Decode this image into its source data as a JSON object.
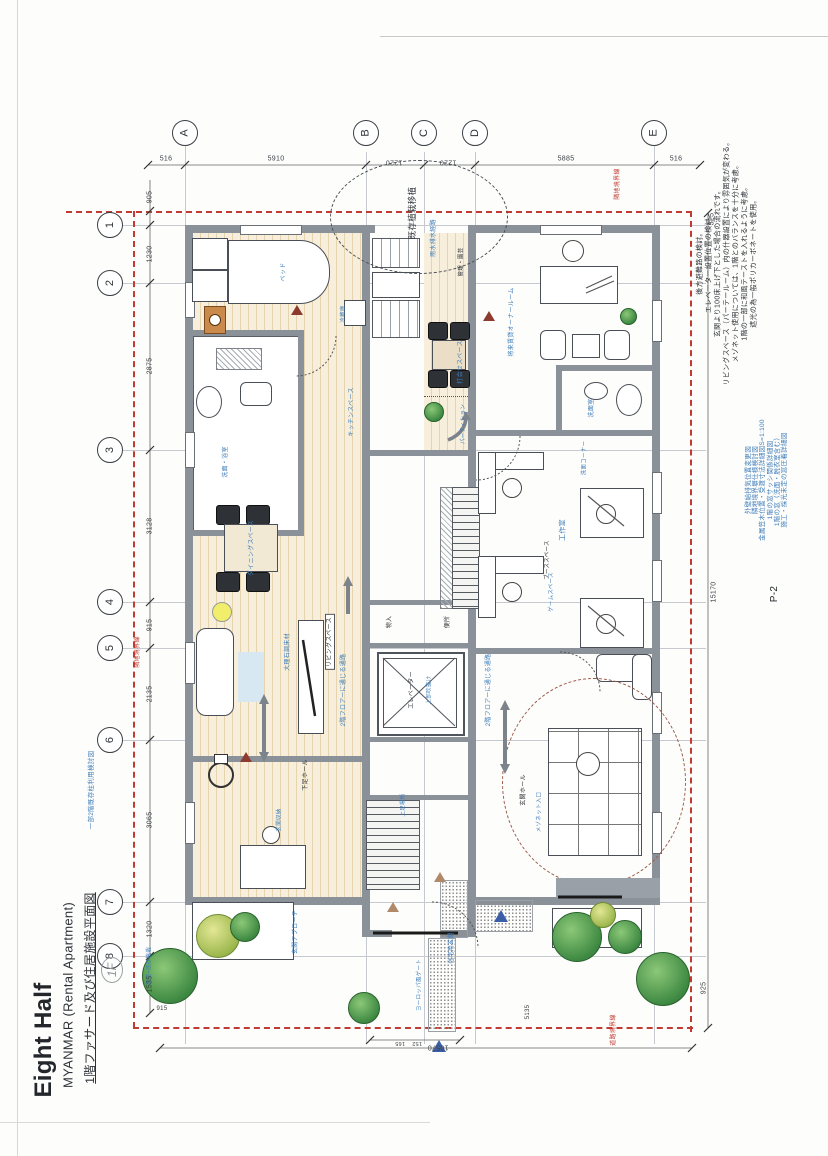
{
  "document": {
    "title": "Eight Half",
    "subtitle": "MYANMAR (Rental Apartment)",
    "drawing_title": "1階ファサード及び住居施設平面図",
    "handwritten_mark": "1F",
    "sheet_number": "P-2"
  },
  "grid": {
    "columns": [
      {
        "label": "A",
        "x": 185
      },
      {
        "label": "B",
        "x": 366
      },
      {
        "label": "C",
        "x": 424
      },
      {
        "label": "D",
        "x": 475
      },
      {
        "label": "E",
        "x": 654
      }
    ],
    "rows": [
      {
        "label": "1",
        "y": 225
      },
      {
        "label": "2",
        "y": 283
      },
      {
        "label": "3",
        "y": 450
      },
      {
        "label": "4",
        "y": 602
      },
      {
        "label": "5",
        "y": 648
      },
      {
        "label": "6",
        "y": 740
      },
      {
        "label": "7",
        "y": 902
      },
      {
        "label": "8",
        "y": 956
      }
    ]
  },
  "dimensions": [
    {
      "t": "516",
      "x": 166,
      "y": 159,
      "r": 0
    },
    {
      "t": "5910",
      "x": 276,
      "y": 159,
      "r": 0
    },
    {
      "t": "1220",
      "x": 394,
      "y": 162,
      "r": 180
    },
    {
      "t": "1220",
      "x": 448,
      "y": 162,
      "r": 180
    },
    {
      "t": "5885",
      "x": 566,
      "y": 159,
      "r": 0
    },
    {
      "t": "516",
      "x": 676,
      "y": 159,
      "r": 0
    },
    {
      "t": "905",
      "x": 150,
      "y": 197
    },
    {
      "t": "1230",
      "x": 150,
      "y": 254
    },
    {
      "t": "2875",
      "x": 150,
      "y": 366
    },
    {
      "t": "3128",
      "x": 150,
      "y": 526
    },
    {
      "t": "915",
      "x": 150,
      "y": 625
    },
    {
      "t": "2135",
      "x": 150,
      "y": 694
    },
    {
      "t": "3065",
      "x": 150,
      "y": 820
    },
    {
      "t": "1320",
      "x": 150,
      "y": 929
    },
    {
      "t": "1535",
      "x": 150,
      "y": 984
    },
    {
      "t": "325",
      "x": 712,
      "y": 219
    },
    {
      "t": "15170",
      "x": 714,
      "y": 592
    },
    {
      "t": "925",
      "x": 704,
      "y": 988
    },
    {
      "t": "10570",
      "x": 438,
      "y": 1047,
      "r": 180
    },
    {
      "t": "165",
      "x": 400,
      "y": 1042,
      "r": 180,
      "s": 5.5
    },
    {
      "t": "152",
      "x": 417,
      "y": 1042,
      "r": 180,
      "s": 5.5
    },
    {
      "t": "5135",
      "x": 528,
      "y": 1012,
      "s": 6
    },
    {
      "t": "915",
      "x": 162,
      "y": 1009,
      "r": 0,
      "s": 6
    }
  ],
  "notes_black": [
    "後方避難路の検討。",
    "エレベーター設置位置の検討。",
    "玄関より100床上げ下とした場合の流れです。",
    "リビングスペース（パーテールーム）内の什器設置により雰囲気が変わる。",
    "メゾネット使用については、1階とのバランスを十分に考慮。",
    "1階の一部に和風テーストを入れるように考慮。",
    "遮光の為一般ポリカーボネートを使用。"
  ],
  "notes_blue": [
    "外壁給排気位置変更図",
    "隣地境界塀仕様検討図",
    "金属笠木位置・受渡寸法詳細図S=1:100",
    "1階の窓サッシ関係詳細図",
    "1階の窓（洗面・脱衣室含む）",
    "施工・採光未定の窓圧着詳細図"
  ],
  "plan_labels": [
    {
      "t": "ベッド",
      "x": 284,
      "y": 272,
      "s": 6,
      "c": "blue"
    },
    {
      "t": "洗面・浴室",
      "x": 226,
      "y": 462,
      "s": 6,
      "c": "blue"
    },
    {
      "t": "ダイニングスペース",
      "x": 252,
      "y": 548,
      "s": 6,
      "c": "blue"
    },
    {
      "t": "リビングスペース",
      "x": 330,
      "y": 642,
      "s": 6,
      "c": "black",
      "box": true
    },
    {
      "t": "大理石調床材",
      "x": 288,
      "y": 652,
      "s": 6,
      "c": "blue"
    },
    {
      "t": "キッチンスペース",
      "x": 352,
      "y": 412,
      "s": 6,
      "c": "blue"
    },
    {
      "t": "冷蔵庫",
      "x": 344,
      "y": 314,
      "s": 5.5,
      "c": "blue"
    },
    {
      "t": "下足ホール",
      "x": 306,
      "y": 775,
      "s": 6,
      "c": "black"
    },
    {
      "t": "玄関収納",
      "x": 280,
      "y": 820,
      "s": 5.5,
      "c": "blue"
    },
    {
      "t": "住宅用玄関",
      "x": 452,
      "y": 948,
      "s": 6,
      "c": "blue"
    },
    {
      "t": "玄関アプローチ",
      "x": 296,
      "y": 932,
      "s": 6,
      "c": "blue"
    },
    {
      "t": "ヨーロッパ風ゲート",
      "x": 420,
      "y": 985,
      "s": 5.5,
      "c": "blue"
    },
    {
      "t": "既存植栽移植",
      "x": 412,
      "y": 213,
      "s": 8.5,
      "c": "black"
    },
    {
      "t": "雨水排水経路",
      "x": 434,
      "y": 238,
      "s": 6,
      "c": "blue"
    },
    {
      "t": "管理・園芸",
      "x": 462,
      "y": 262,
      "s": 5.5,
      "c": "black"
    },
    {
      "t": "エレベーター",
      "x": 412,
      "y": 690,
      "s": 6,
      "c": "black"
    },
    {
      "t": "上部吹抜け",
      "x": 430,
      "y": 690,
      "s": 5.5,
      "c": "blue"
    },
    {
      "t": "便所",
      "x": 448,
      "y": 622,
      "s": 6,
      "c": "black"
    },
    {
      "t": "物入",
      "x": 390,
      "y": 622,
      "s": 6,
      "c": "black"
    },
    {
      "t": "打合せスペース",
      "x": 461,
      "y": 362,
      "s": 6,
      "c": "blue"
    },
    {
      "t": "パーティション",
      "x": 464,
      "y": 424,
      "s": 5.5,
      "c": "blue"
    },
    {
      "t": "将来賃貸オーナールーム",
      "x": 512,
      "y": 322,
      "s": 6,
      "c": "blue"
    },
    {
      "t": "洗面室",
      "x": 592,
      "y": 408,
      "s": 6,
      "c": "blue"
    },
    {
      "t": "洗面コーナー",
      "x": 585,
      "y": 458,
      "s": 5.5,
      "c": "blue"
    },
    {
      "t": "工作室",
      "x": 563,
      "y": 530,
      "s": 7,
      "c": "blue"
    },
    {
      "t": "ブーススペース",
      "x": 548,
      "y": 560,
      "s": 5.5,
      "c": "black"
    },
    {
      "t": "ゲームスペース",
      "x": 552,
      "y": 592,
      "s": 5.5,
      "c": "blue"
    },
    {
      "t": "2階フロアーに通じる通路",
      "x": 344,
      "y": 690,
      "s": 6,
      "c": "blue"
    },
    {
      "t": "2階フロアーに通じる通路",
      "x": 489,
      "y": 690,
      "s": 6,
      "c": "blue"
    },
    {
      "t": "玄関ホール",
      "x": 524,
      "y": 790,
      "s": 6,
      "c": "black"
    },
    {
      "t": "メゾネット入口",
      "x": 540,
      "y": 812,
      "s": 5.5,
      "c": "blue"
    },
    {
      "t": "上足場所",
      "x": 404,
      "y": 805,
      "s": 5.5,
      "c": "blue"
    },
    {
      "t": "隣地境界線",
      "x": 618,
      "y": 184,
      "s": 6,
      "c": "red"
    },
    {
      "t": "隣地境界線",
      "x": 138,
      "y": 652,
      "s": 6,
      "c": "red"
    },
    {
      "t": "道路境界線",
      "x": 614,
      "y": 1030,
      "s": 6,
      "c": "red"
    },
    {
      "t": "花壇+既存植栽",
      "x": 150,
      "y": 966,
      "s": 5.5,
      "c": "blue"
    },
    {
      "t": "一部2階既存柱利用検討図",
      "x": 92,
      "y": 790,
      "s": 6.5,
      "c": "blue"
    }
  ],
  "colors": {
    "boundary_red": "#c23b32",
    "annotation_blue": "#3e7db9",
    "wall_gray": "#8b9199",
    "wood_floor": "#f7efdc",
    "tree_green": "#3f8a43",
    "tree_yellow": "#9db84e"
  }
}
